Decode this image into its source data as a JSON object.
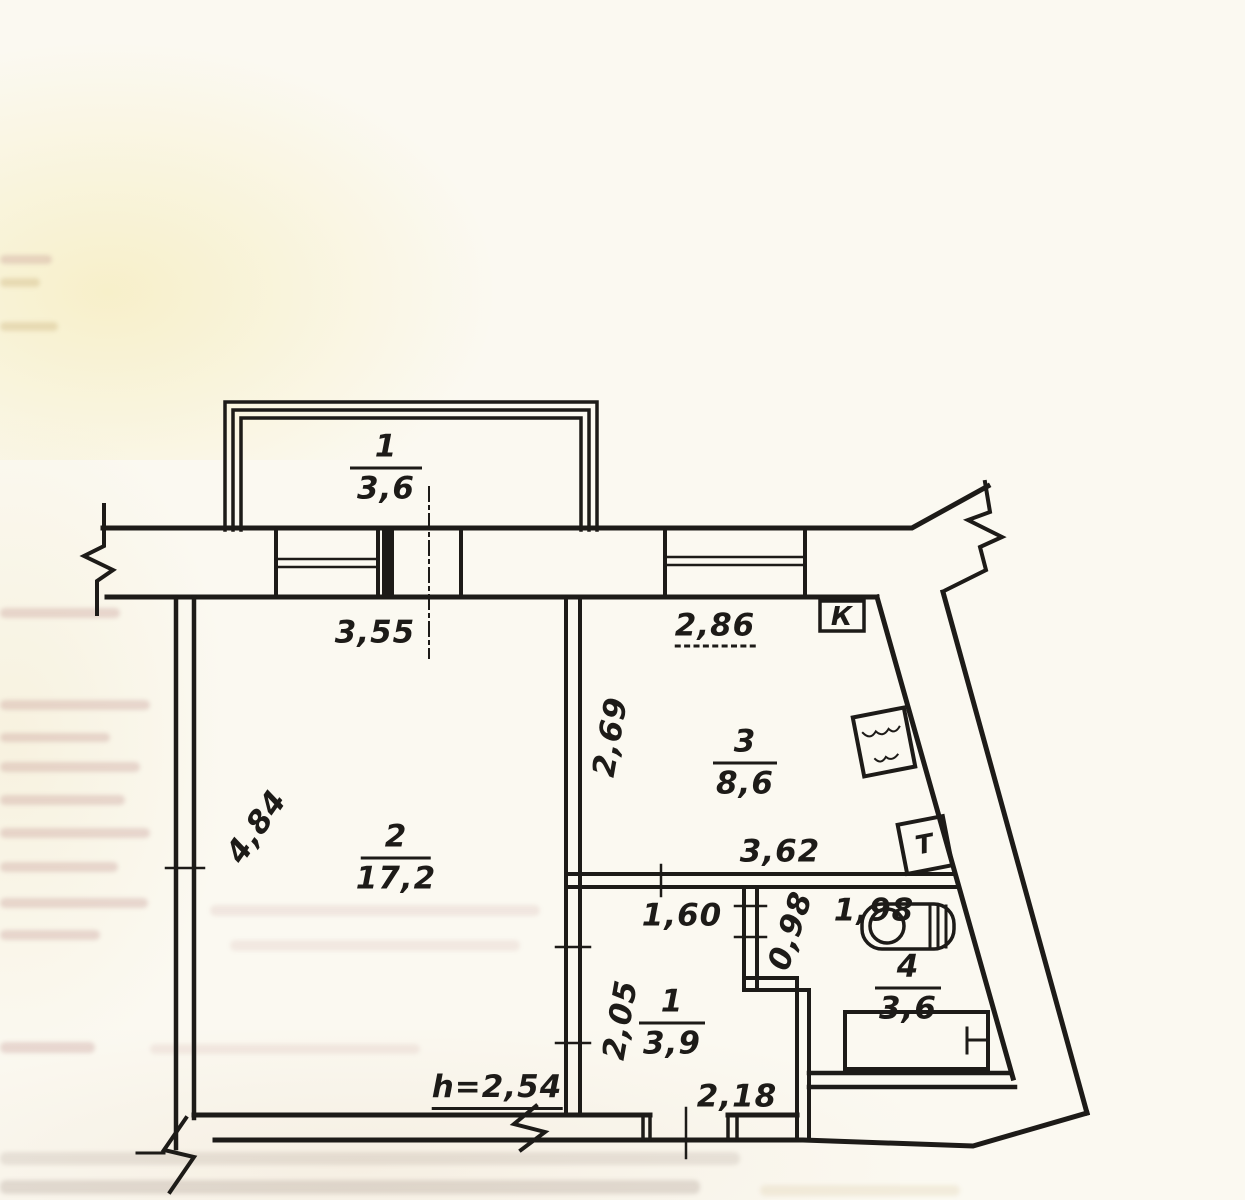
{
  "plan": {
    "rooms": {
      "balcony": {
        "number": "1",
        "area": "3,6"
      },
      "living": {
        "number": "2",
        "area": "17,2"
      },
      "kitchen": {
        "number": "3",
        "area": "8,6"
      },
      "hall": {
        "number": "1",
        "area": "3,9"
      },
      "bathroom": {
        "number": "4",
        "area": "3,6"
      }
    },
    "dimensions": {
      "balcony_width": "3,55",
      "kitchen_window": "2,86",
      "kitchen_depth": "2,69",
      "kitchen_width": "3,62",
      "living_depth": "4,84",
      "hall_width": "1,60",
      "nook_width": "0,98",
      "toilet_width": "1,98",
      "hall_depth": "2,05",
      "hall_bottom_width": "2,18",
      "ceiling_height": "h=2,54"
    },
    "markers": {
      "kitchen_box": "К",
      "toilet_box": "Т"
    },
    "colors": {
      "ink": "#1d1b18",
      "paper": "#fbf9f1"
    }
  }
}
